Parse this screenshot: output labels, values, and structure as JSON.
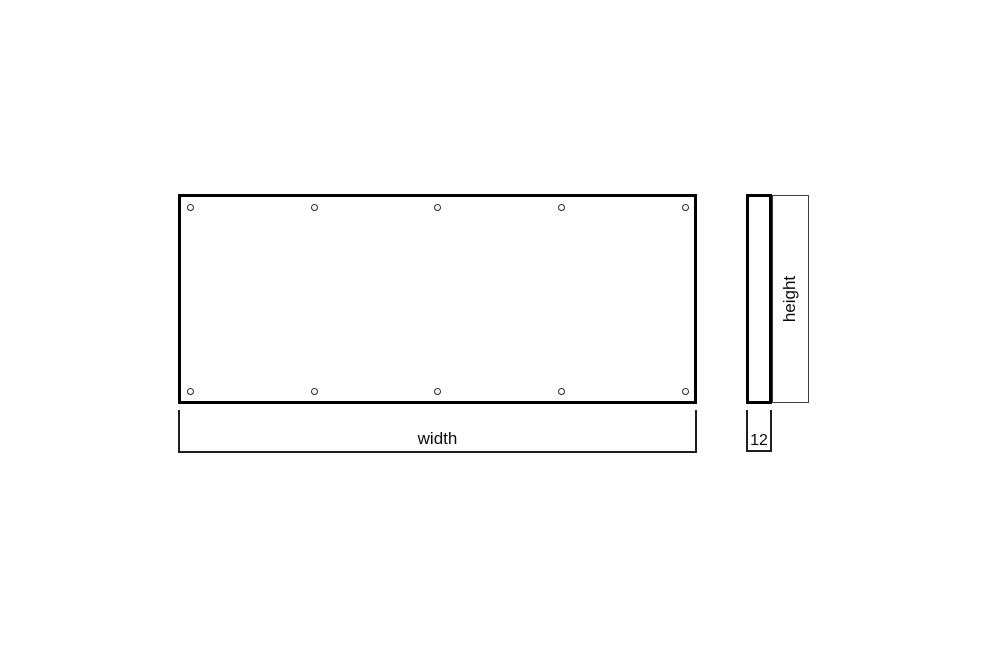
{
  "diagram": {
    "front_view": {
      "dimension_label": "width",
      "hole_rows": 2,
      "hole_columns": 5,
      "hole_count": 10
    },
    "side_view": {
      "dimension_label": "height",
      "thickness_value": "12"
    },
    "colors": {
      "line": "#000000",
      "thin_line": "#3c3c3c",
      "background": "#ffffff"
    }
  }
}
